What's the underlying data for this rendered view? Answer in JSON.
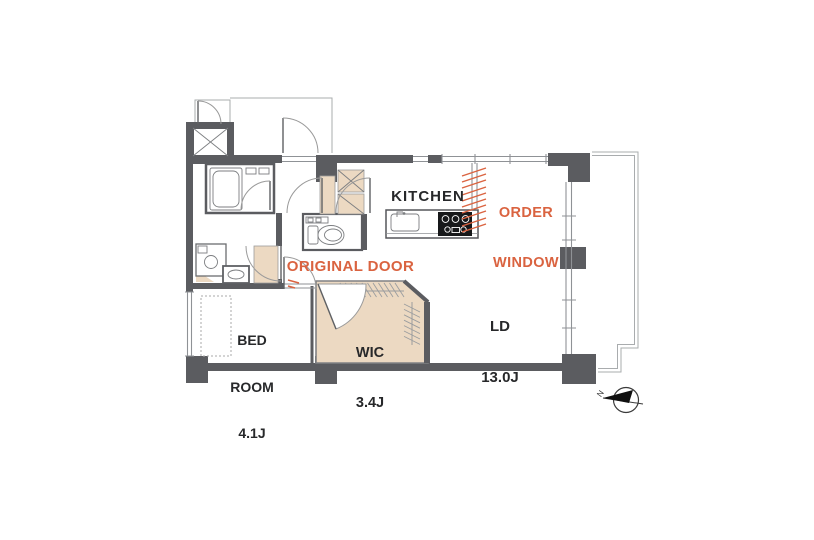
{
  "plan": {
    "rooms": {
      "kitchen": {
        "name": "KITCHEN"
      },
      "ld": {
        "name": "LD",
        "size": "13.0J"
      },
      "bedroom": {
        "name_line1": "BED",
        "name_line2": "ROOM",
        "size": "4.1J"
      },
      "wic": {
        "name": "WIC",
        "size": "3.4J"
      }
    },
    "annotations": {
      "order_window": {
        "line1": "ORDER",
        "line2": "WINDOW"
      },
      "original_door": {
        "text": "ORIGINAL DOOR"
      }
    },
    "compass": {
      "north": "N"
    },
    "colors": {
      "wall": "#5b5c60",
      "closet_tan": "#ecd9c2",
      "accent_orange": "#da6340",
      "text": "#27282a"
    }
  }
}
